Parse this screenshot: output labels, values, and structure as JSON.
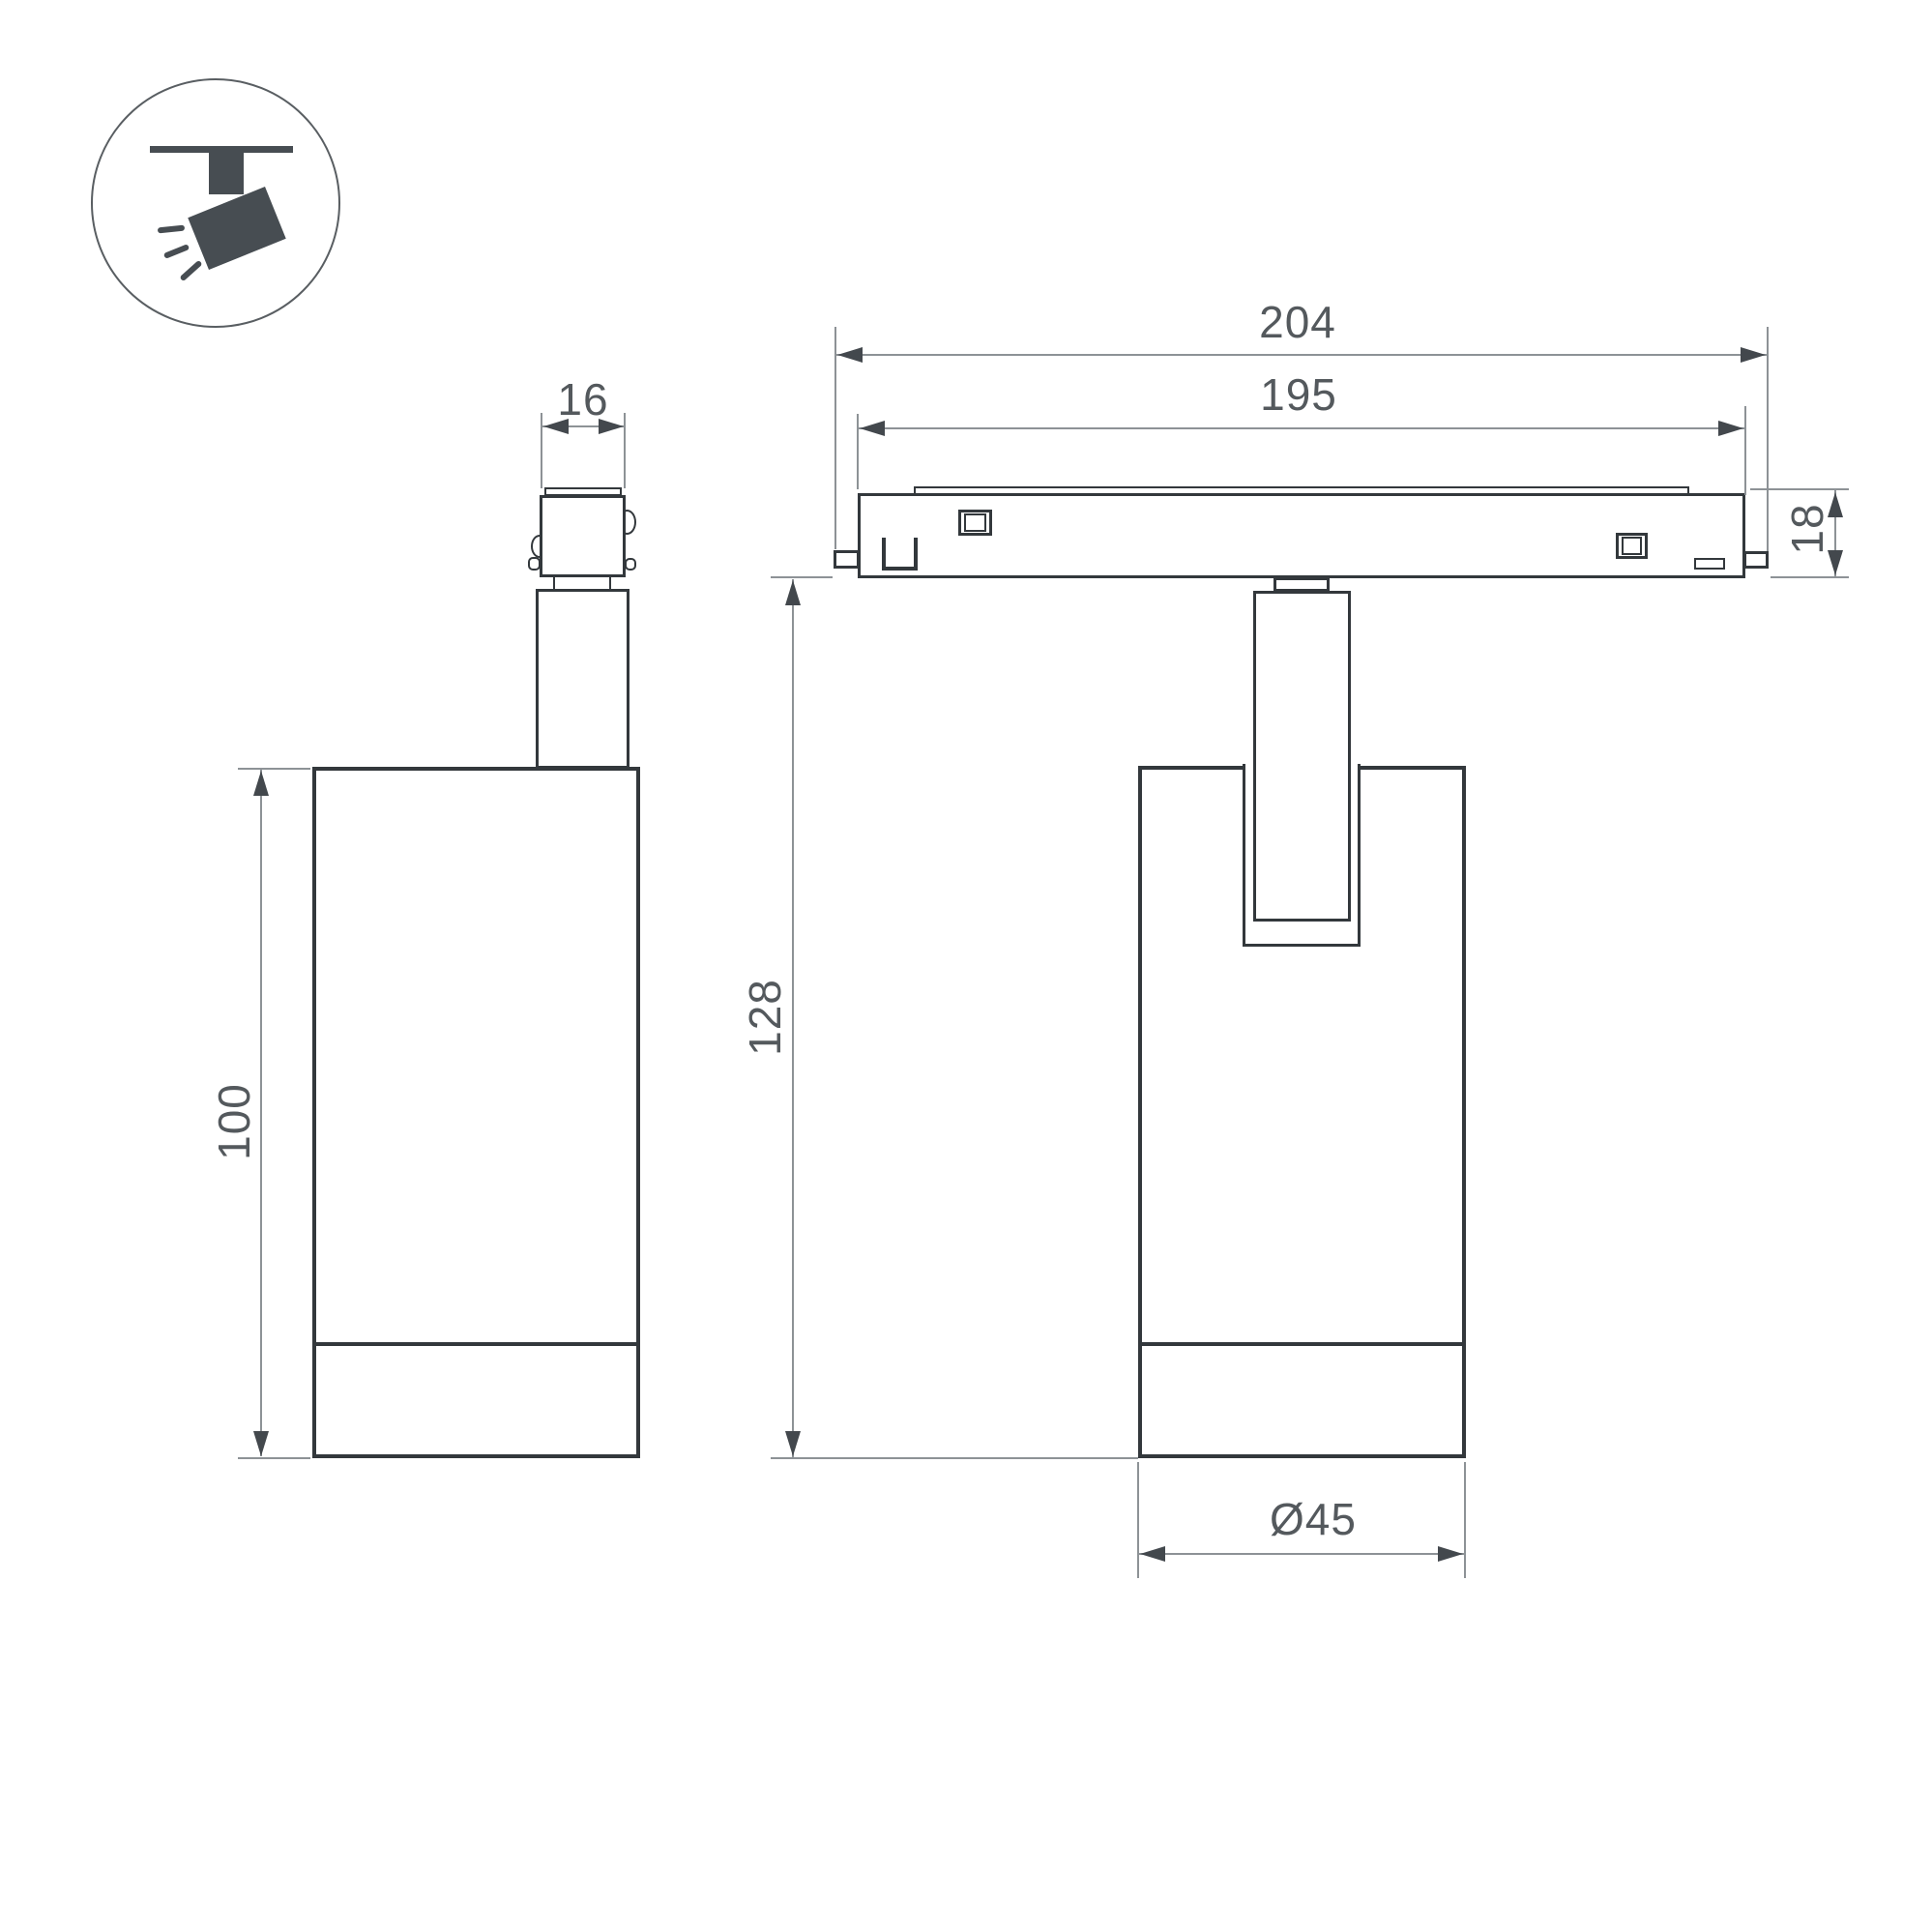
{
  "drawing": {
    "title_icon": "track-spotlight",
    "labels": {
      "connector_width": "16",
      "track_length_outer": "204",
      "track_length_inner": "195",
      "track_height": "18",
      "body_height": "100",
      "total_height": "128",
      "body_diameter": "Ø45"
    },
    "colors": {
      "outline": "#33383c",
      "thin": "#8d9296",
      "arrow": "#43484d",
      "text": "#54595d",
      "icon": "#474d52"
    }
  }
}
